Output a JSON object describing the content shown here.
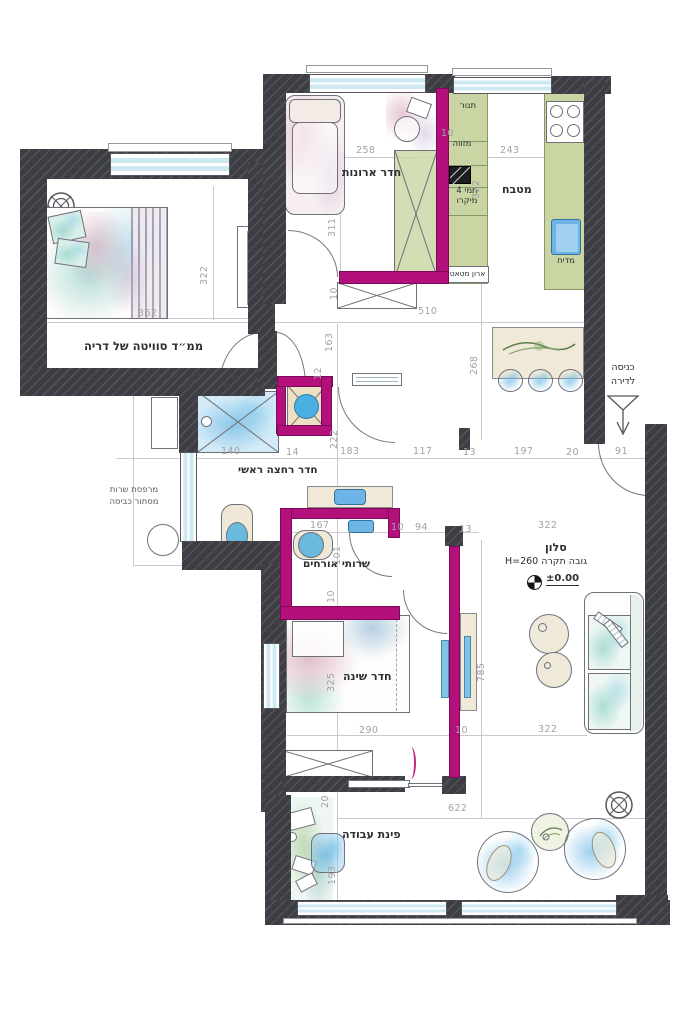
{
  "plan": {
    "rooms": {
      "mamad": "ממ״ד סוויטה של דריה",
      "closet": "חדר ארונות",
      "kitchen": "מטבח",
      "bath": "חדר רחצה ראשי",
      "guest_wc": "שרותי אורחים",
      "salon": "סלון",
      "bedroom": "חדר שינה",
      "work": "פינת עבודה"
    },
    "salon_info": {
      "ceiling": "גובה תקרה H=260",
      "level": "±0.00"
    },
    "balcony": {
      "line1": "מרפסת שרות",
      "line2": "מסתור כביסה"
    },
    "entrance": {
      "line1": "כניסה",
      "line2": "לדירה"
    },
    "kitchen_items": {
      "oven": "תנור",
      "pantry": "מזווה",
      "tami": "תמי 4",
      "micro": "מיקרו",
      "broom": "ארון מטאטא",
      "dishwasher": "מדיח"
    },
    "colors": {
      "wall": "#3d3d44",
      "new_wall": "#b3107c",
      "window": "#cfe9f2",
      "dim_text": "#a2a2a8",
      "label_text": "#2e2e33"
    },
    "dimensions": [
      {
        "t": "362",
        "x": 138,
        "y": 308
      },
      {
        "t": "322",
        "x": 199,
        "y": 258,
        "v": 1
      },
      {
        "t": "258",
        "x": 356,
        "y": 145
      },
      {
        "t": "311",
        "x": 327,
        "y": 210,
        "v": 1
      },
      {
        "t": "10",
        "x": 329,
        "y": 280,
        "v": 1
      },
      {
        "t": "10",
        "x": 441,
        "y": 128
      },
      {
        "t": "243",
        "x": 500,
        "y": 145
      },
      {
        "t": "322",
        "x": 471,
        "y": 172,
        "v": 1
      },
      {
        "t": "510",
        "x": 418,
        "y": 306
      },
      {
        "t": "163",
        "x": 324,
        "y": 325,
        "v": 1
      },
      {
        "t": "12",
        "x": 313,
        "y": 360,
        "v": 1
      },
      {
        "t": "268",
        "x": 469,
        "y": 348,
        "v": 1
      },
      {
        "t": "222",
        "x": 329,
        "y": 422,
        "v": 1
      },
      {
        "t": "140",
        "x": 221,
        "y": 446
      },
      {
        "t": "14",
        "x": 286,
        "y": 447
      },
      {
        "t": "183",
        "x": 340,
        "y": 446
      },
      {
        "t": "117",
        "x": 413,
        "y": 446
      },
      {
        "t": "13",
        "x": 463,
        "y": 447
      },
      {
        "t": "197",
        "x": 514,
        "y": 446
      },
      {
        "t": "20",
        "x": 566,
        "y": 447
      },
      {
        "t": "91",
        "x": 615,
        "y": 446
      },
      {
        "t": "167",
        "x": 310,
        "y": 520
      },
      {
        "t": "101",
        "x": 332,
        "y": 538,
        "v": 1
      },
      {
        "t": "10",
        "x": 391,
        "y": 522
      },
      {
        "t": "94",
        "x": 415,
        "y": 522
      },
      {
        "t": "13",
        "x": 459,
        "y": 524
      },
      {
        "t": "10",
        "x": 326,
        "y": 583,
        "v": 1
      },
      {
        "t": "322",
        "x": 538,
        "y": 520
      },
      {
        "t": "785",
        "x": 476,
        "y": 655,
        "v": 1
      },
      {
        "t": "325",
        "x": 326,
        "y": 665,
        "v": 1
      },
      {
        "t": "290",
        "x": 359,
        "y": 725
      },
      {
        "t": "10",
        "x": 455,
        "y": 725
      },
      {
        "t": "322",
        "x": 538,
        "y": 724
      },
      {
        "t": "20",
        "x": 320,
        "y": 788,
        "v": 1
      },
      {
        "t": "622",
        "x": 448,
        "y": 803
      },
      {
        "t": "193",
        "x": 327,
        "y": 858,
        "v": 1
      }
    ]
  }
}
